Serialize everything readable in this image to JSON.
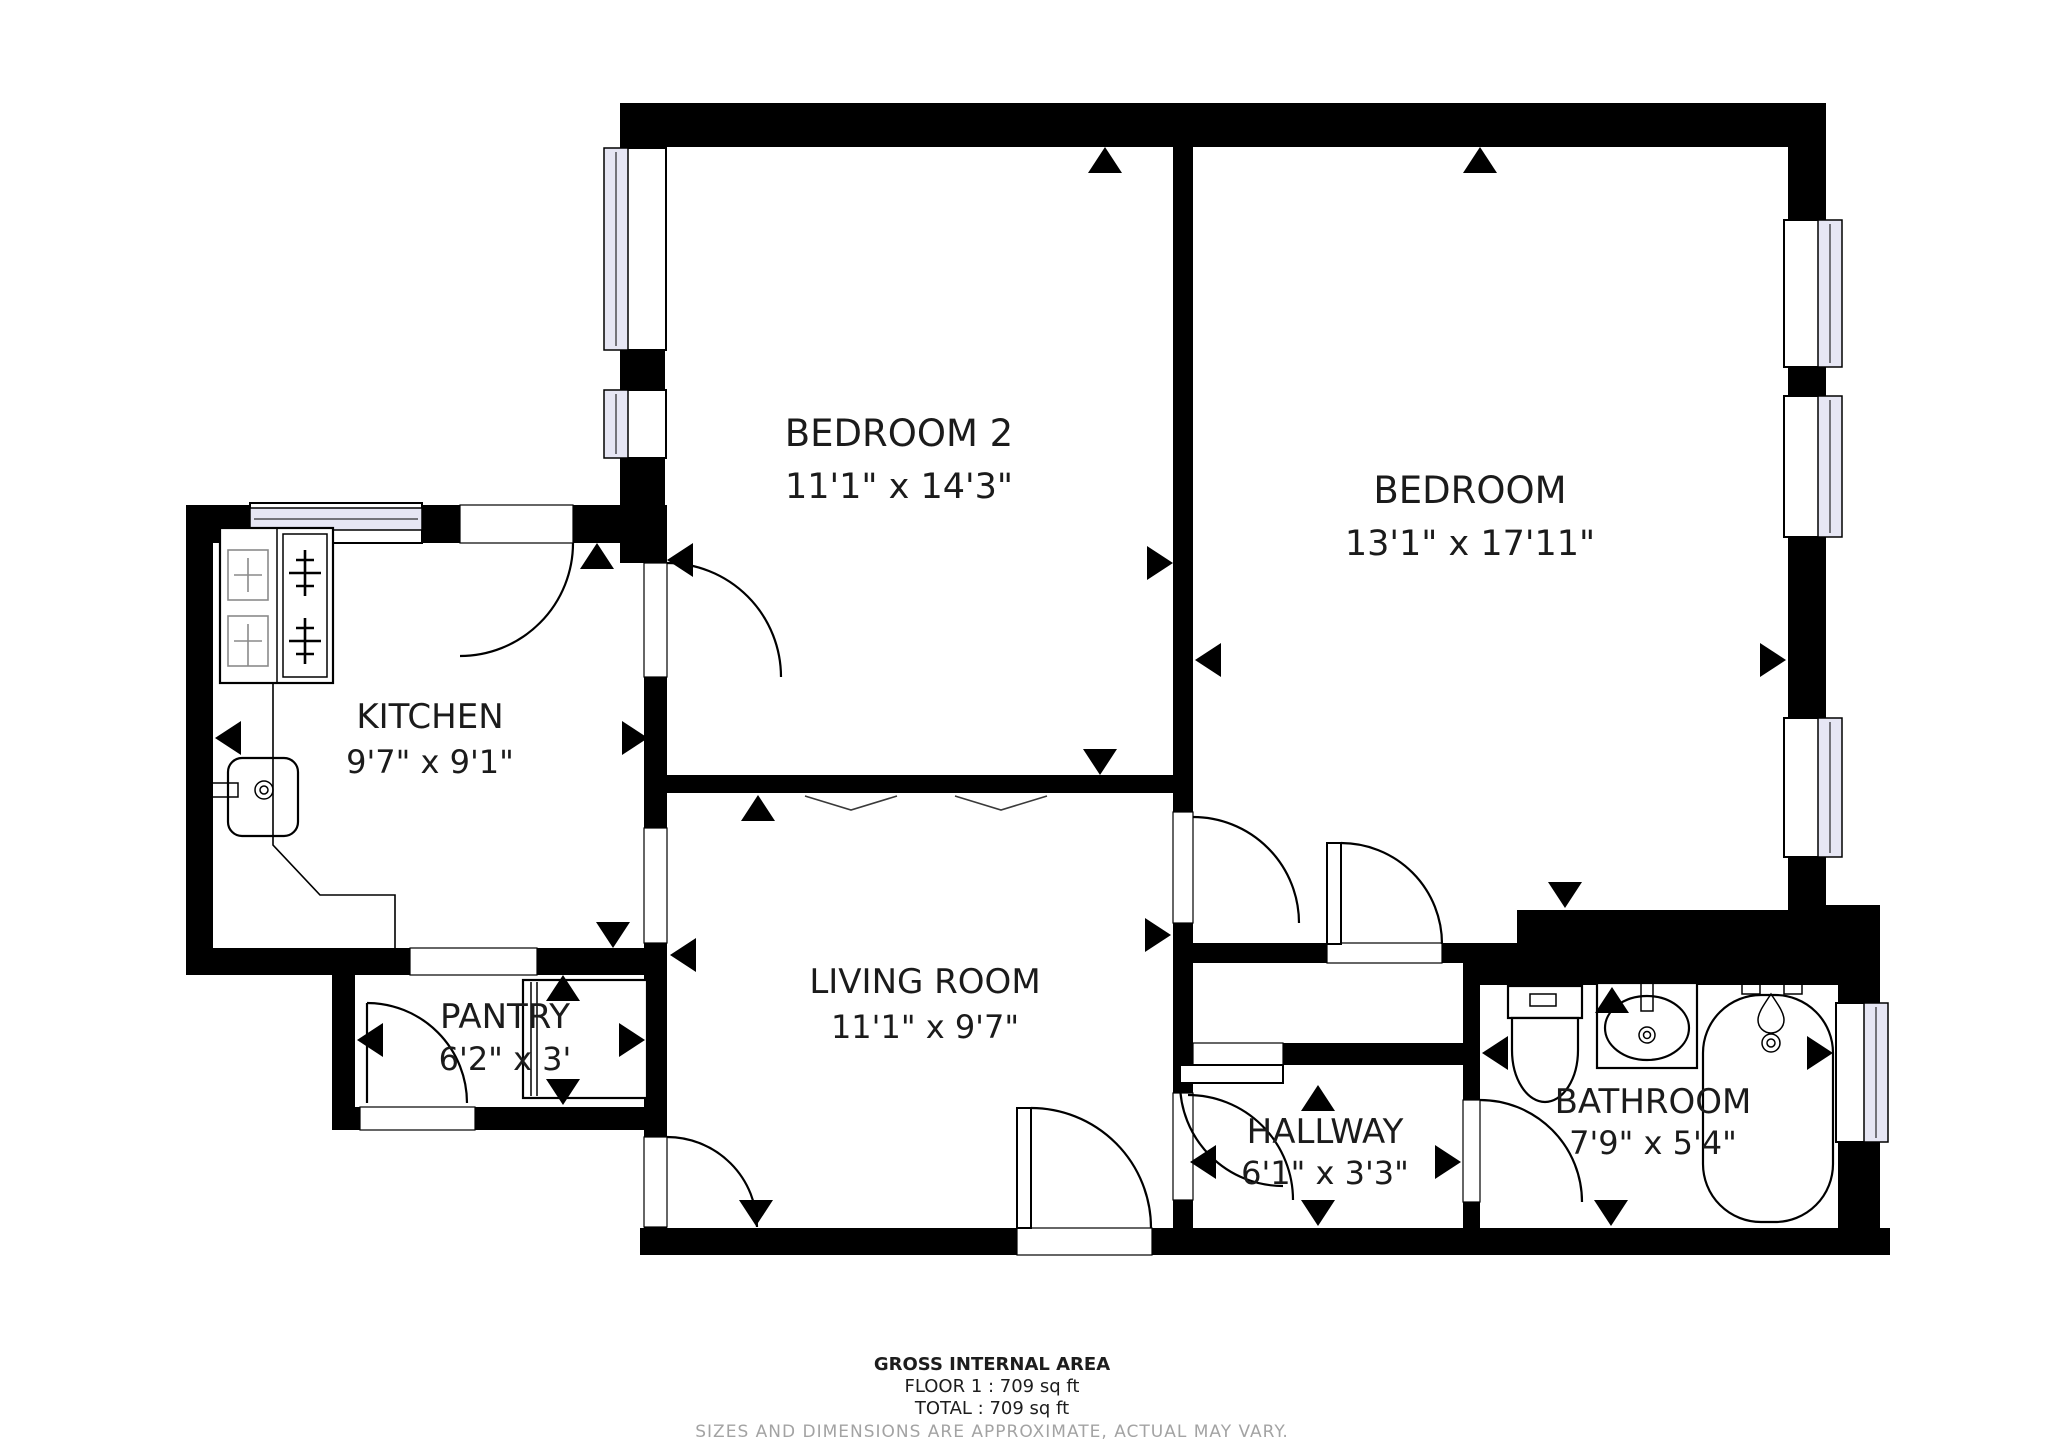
{
  "plan": {
    "rooms": [
      {
        "name": "BEDROOM 2",
        "dims": "11'1\" x 14'3\""
      },
      {
        "name": "BEDROOM",
        "dims": "13'1\" x 17'11\""
      },
      {
        "name": "KITCHEN",
        "dims": "9'7\" x 9'1\""
      },
      {
        "name": "PANTRY",
        "dims": "6'2\" x 3'"
      },
      {
        "name": "LIVING ROOM",
        "dims": "11'1\" x 9'7\""
      },
      {
        "name": "HALLWAY",
        "dims": "6'1\" x 3'3\""
      },
      {
        "name": "BATHROOM",
        "dims": "7'9\" x 5'4\""
      }
    ],
    "footer": {
      "title": "GROSS INTERNAL AREA",
      "floor_line": "FLOOR 1 : 709 sq ft",
      "total_line": "TOTAL : 709 sq ft",
      "disclaimer": "SIZES AND DIMENSIONS ARE APPROXIMATE, ACTUAL MAY VARY."
    },
    "colors": {
      "wall": "#000000",
      "glazing": "#e6e6f4",
      "floor": "#ffffff",
      "muted": "#a3a3a3"
    }
  }
}
